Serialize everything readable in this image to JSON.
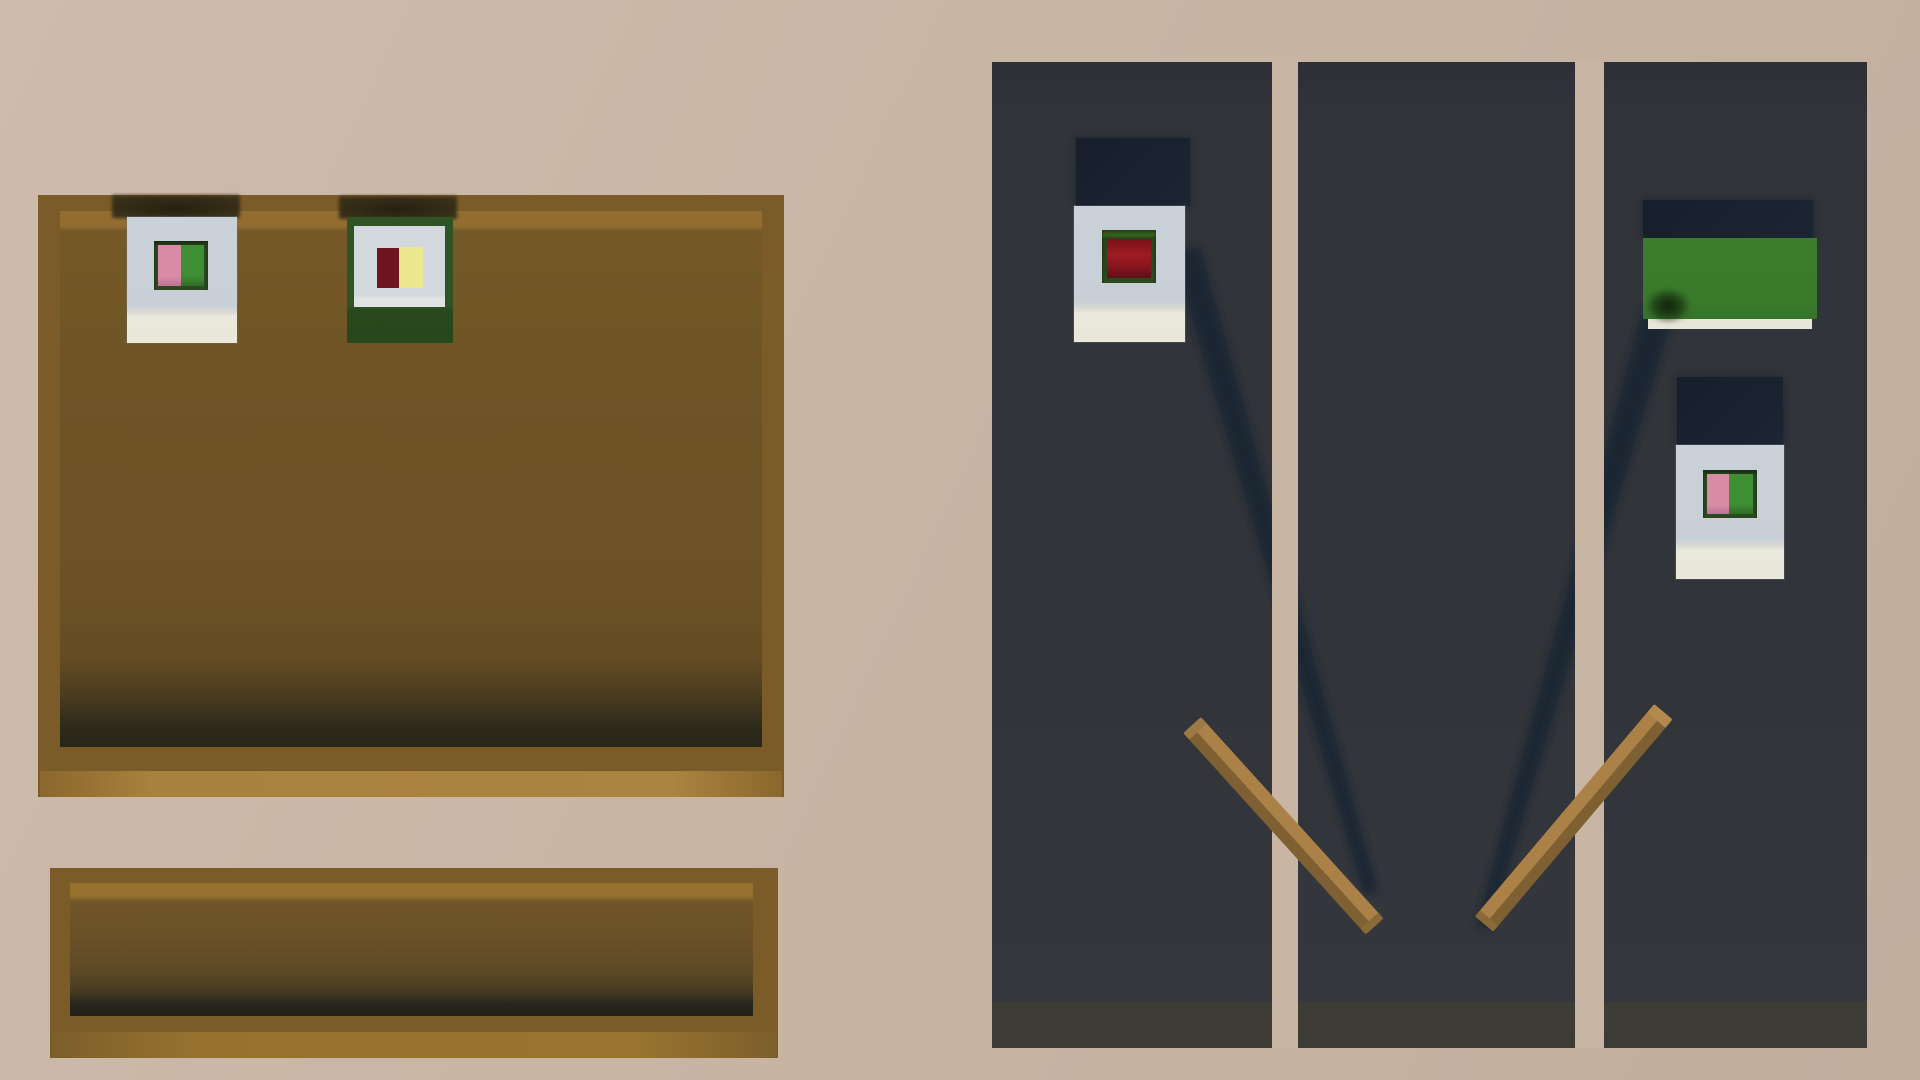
{
  "scene": {
    "view": "top-down low-poly 3D room render",
    "objects": [
      {
        "id": "wall-board",
        "label": "wooden pin board",
        "items": [
          "white card with pink-green picture",
          "green card with red-yellow picture"
        ]
      },
      {
        "id": "wooden-tray",
        "label": "empty wooden tray shelf",
        "items": []
      },
      {
        "id": "dark-panel-1",
        "label": "dark display panel",
        "items": [
          "white card with dark-red picture"
        ]
      },
      {
        "id": "dark-panel-2",
        "label": "dark display panel",
        "items": []
      },
      {
        "id": "dark-panel-3",
        "label": "dark display panel",
        "items": [
          "green box",
          "white card with pink-green picture"
        ]
      },
      {
        "id": "stick-left",
        "label": "wooden stick leaning right"
      },
      {
        "id": "stick-right",
        "label": "wooden stick leaning left"
      }
    ]
  },
  "palette": {
    "bg": "#c8b5a4",
    "bgLight": "#cdbbac",
    "bgDark": "#c1ae9d",
    "wood": "#7b5b27",
    "woodBright": "#a8813c",
    "woodTop": "#926d2f",
    "surface": "#6f5426",
    "surfaceDark": "#2e2b1c",
    "traySurface": "#6a5126",
    "panel": "#313439",
    "panelStrip": "#3e3d35",
    "navy": "#1a2230",
    "shadow": "#1a2231",
    "cardWhite": "#cbd1d9",
    "cardCream": "#eae9dc",
    "frameGreen": "#2c4a20",
    "coverGreen": "#2d5422",
    "pink": "#d78ba5",
    "leaf": "#3e8e34",
    "red": "#6f1522",
    "redBright": "#9e1c23",
    "yellow": "#ebe88d",
    "boxGreen": "#3a7d2c",
    "boxEdge": "#e8e6d9",
    "stickLight": "#ab8147",
    "stickDark": "#7f6032",
    "capLight": "#9d7944",
    "capBright": "#b28a4e",
    "capDark": "#8a6a37"
  }
}
